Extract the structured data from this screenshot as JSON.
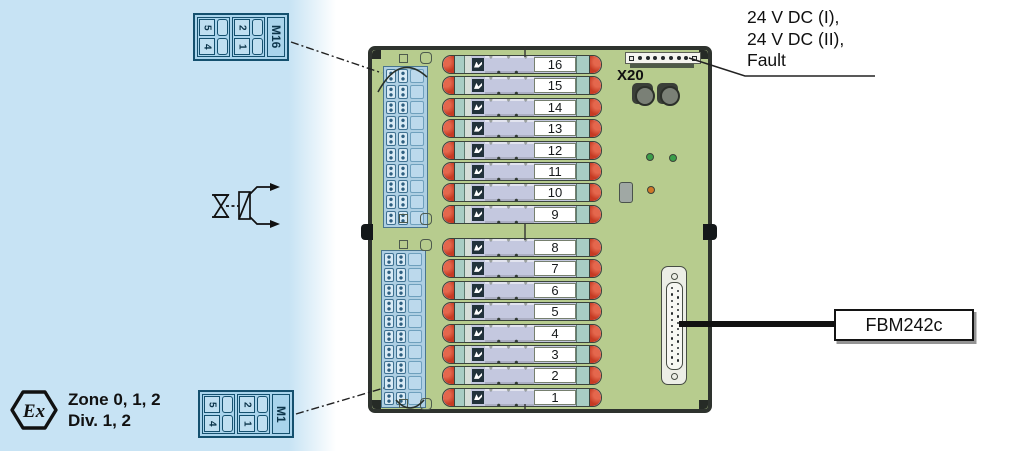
{
  "hazard_zone": {
    "ex_mark": "Ex",
    "zone_text": "Zone 0, 1, 2",
    "div_text": "Div. 1, 2"
  },
  "field_terminals": {
    "top_block": {
      "label": "M16",
      "pins": [
        "5",
        "2",
        "4",
        "1"
      ]
    },
    "bottom_block": {
      "label": "M1",
      "pins": [
        "5",
        "2",
        "4",
        "1"
      ]
    }
  },
  "board": {
    "x20_label": "X20",
    "channels_top": [
      "16",
      "15",
      "14",
      "13",
      "12",
      "11",
      "10",
      "9"
    ],
    "channels_bottom": [
      "8",
      "7",
      "6",
      "5",
      "4",
      "3",
      "2",
      "1"
    ]
  },
  "annotations": {
    "power_label_line1": "24 V DC (I),",
    "power_label_line2": "24 V DC (II),",
    "power_label_line3": "Fault",
    "module_label": "FBM242c"
  },
  "colors": {
    "hazard_zone_bg": "#c7e3f4",
    "board_green": "#b7cc8e",
    "module_red": "#c63b24",
    "module_lavender": "#c4c8df",
    "module_teal": "#a8cdc4",
    "terminal_blue": "#a9d4ec",
    "led_green": "#3a9e4a",
    "led_orange": "#d07828"
  }
}
